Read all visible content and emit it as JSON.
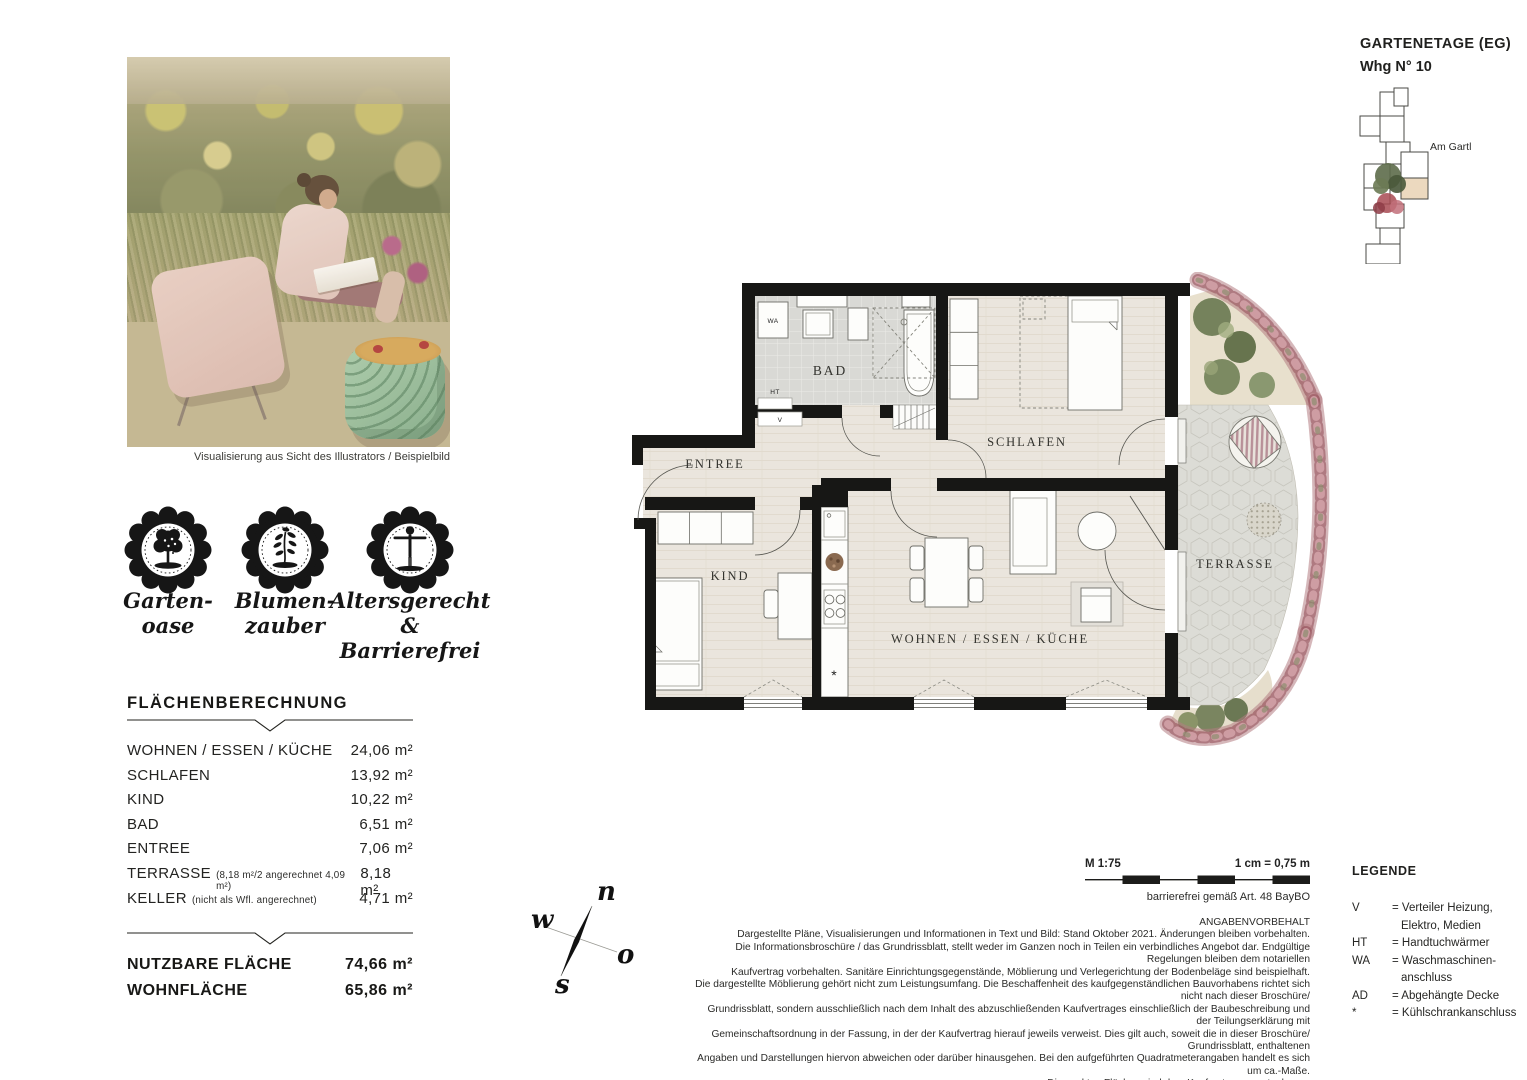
{
  "header": {
    "etage": "GARTENETAGE (EG)",
    "unit": "Whg N° 10",
    "street": "Am Gartl"
  },
  "photo": {
    "caption": "Visualisierung aus Sicht des Illustrators / Beispielbild"
  },
  "badges": [
    {
      "icon": "garden-tree-icon",
      "line1": "Garten-",
      "line2": "oase"
    },
    {
      "icon": "flower-icon",
      "line1": "Blumen-",
      "line2": "zauber"
    },
    {
      "icon": "accessible-person-icon",
      "line1": "Altersgerecht",
      "line2": "& Barrierefrei"
    }
  ],
  "area_table": {
    "title": "FLÄCHENBERECHNUNG",
    "rows": [
      {
        "label": "WOHNEN / ESSEN / KÜCHE",
        "note": "",
        "value": "24,06 m²"
      },
      {
        "label": "SCHLAFEN",
        "note": "",
        "value": "13,92 m²"
      },
      {
        "label": "KIND",
        "note": "",
        "value": "10,22 m²"
      },
      {
        "label": "BAD",
        "note": "",
        "value": "6,51 m²"
      },
      {
        "label": "ENTREE",
        "note": "",
        "value": "7,06 m²"
      },
      {
        "label": "TERRASSE",
        "note": "(8,18 m²/2 angerechnet 4,09 m²)",
        "value": "8,18 m²"
      },
      {
        "label": "KELLER",
        "note": "(nicht als Wfl. angerechnet)",
        "value": "4,71 m²"
      }
    ],
    "totals": [
      {
        "label": "NUTZBARE FLÄCHE",
        "value": "74,66 m²"
      },
      {
        "label": "WOHNFLÄCHE",
        "value": "65,86 m²"
      }
    ]
  },
  "plan": {
    "rooms": {
      "bad": "BAD",
      "entree": "ENTREE",
      "schlafen": "SCHLAFEN",
      "kind": "KIND",
      "wohnen": "WOHNEN / ESSEN / KÜCHE",
      "terrasse": "TERRASSE"
    },
    "marks": {
      "wa": "WA",
      "ht": "HT",
      "v": "V",
      "fridge": "*"
    }
  },
  "compass": {
    "n": "n",
    "w": "w",
    "o": "o",
    "s": "s"
  },
  "scale": {
    "ratio": "M 1:75",
    "cm": "1 cm = 0,75 m",
    "barrier": "barrierefrei gemäß Art. 48 BayBO"
  },
  "legal": {
    "lines": [
      "ANGABENVORBEHALT",
      "Dargestellte Pläne, Visualisierungen und Informationen in Text und Bild: Stand Oktober 2021. Änderungen bleiben vorbehalten.",
      "Die Informationsbroschüre / das Grundrissblatt, stellt weder im Ganzen noch in Teilen ein verbindliches Angebot dar. Endgültige Regelungen bleiben dem notariellen",
      "Kaufvertrag vorbehalten. Sanitäre Einrichtungsgegenstände, Möblierung und Verlegerichtung der Bodenbeläge sind beispielhaft.",
      "Die dargestellte Möblierung gehört nicht zum Leistungsumfang. Die Beschaffenheit des kaufgegenständlichen Bauvorhabens richtet sich nicht nach dieser Broschüre/",
      "Grundrissblatt, sondern ausschließlich nach dem Inhalt des abzuschließenden Kaufvertrages einschließlich der Baubeschreibung und der Teilungserklärung mit",
      "Gemeinschaftsordnung in der Fassung, in der der Kaufvertrag hierauf jeweils verweist. Dies gilt auch, soweit die in dieser Broschüre/ Grundrissblatt, enthaltenen",
      "Angaben und Darstellungen hiervon abweichen oder darüber hinausgehen. Bei den aufgeführten Quadratmeterangaben handelt es sich um ca.-Maße.",
      "Die exakten Flächen sind dem Kaufvertrag zu entnehmen."
    ]
  },
  "legend": {
    "title": "LEGENDE",
    "items": [
      {
        "sym": "V",
        "line1": "= Verteiler Heizung,",
        "line2": "Elektro, Medien"
      },
      {
        "sym": "HT",
        "line1": "= Handtuchwärmer",
        "line2": ""
      },
      {
        "sym": "WA",
        "line1": "= Waschmaschinen-",
        "line2": "anschluss"
      },
      {
        "sym": "AD",
        "line1": "= Abgehängte Decke",
        "line2": ""
      },
      {
        "sym": "*",
        "line1": "= Kühlschrankanschluss",
        "line2": ""
      }
    ]
  },
  "colors": {
    "wall": "#171715",
    "floor": "#eae5dd",
    "bad_tile": "#d9d9d5",
    "terrace": "#dcdcd6",
    "hedge": "#96525c",
    "highlight_unit": "#ecd9bf"
  }
}
